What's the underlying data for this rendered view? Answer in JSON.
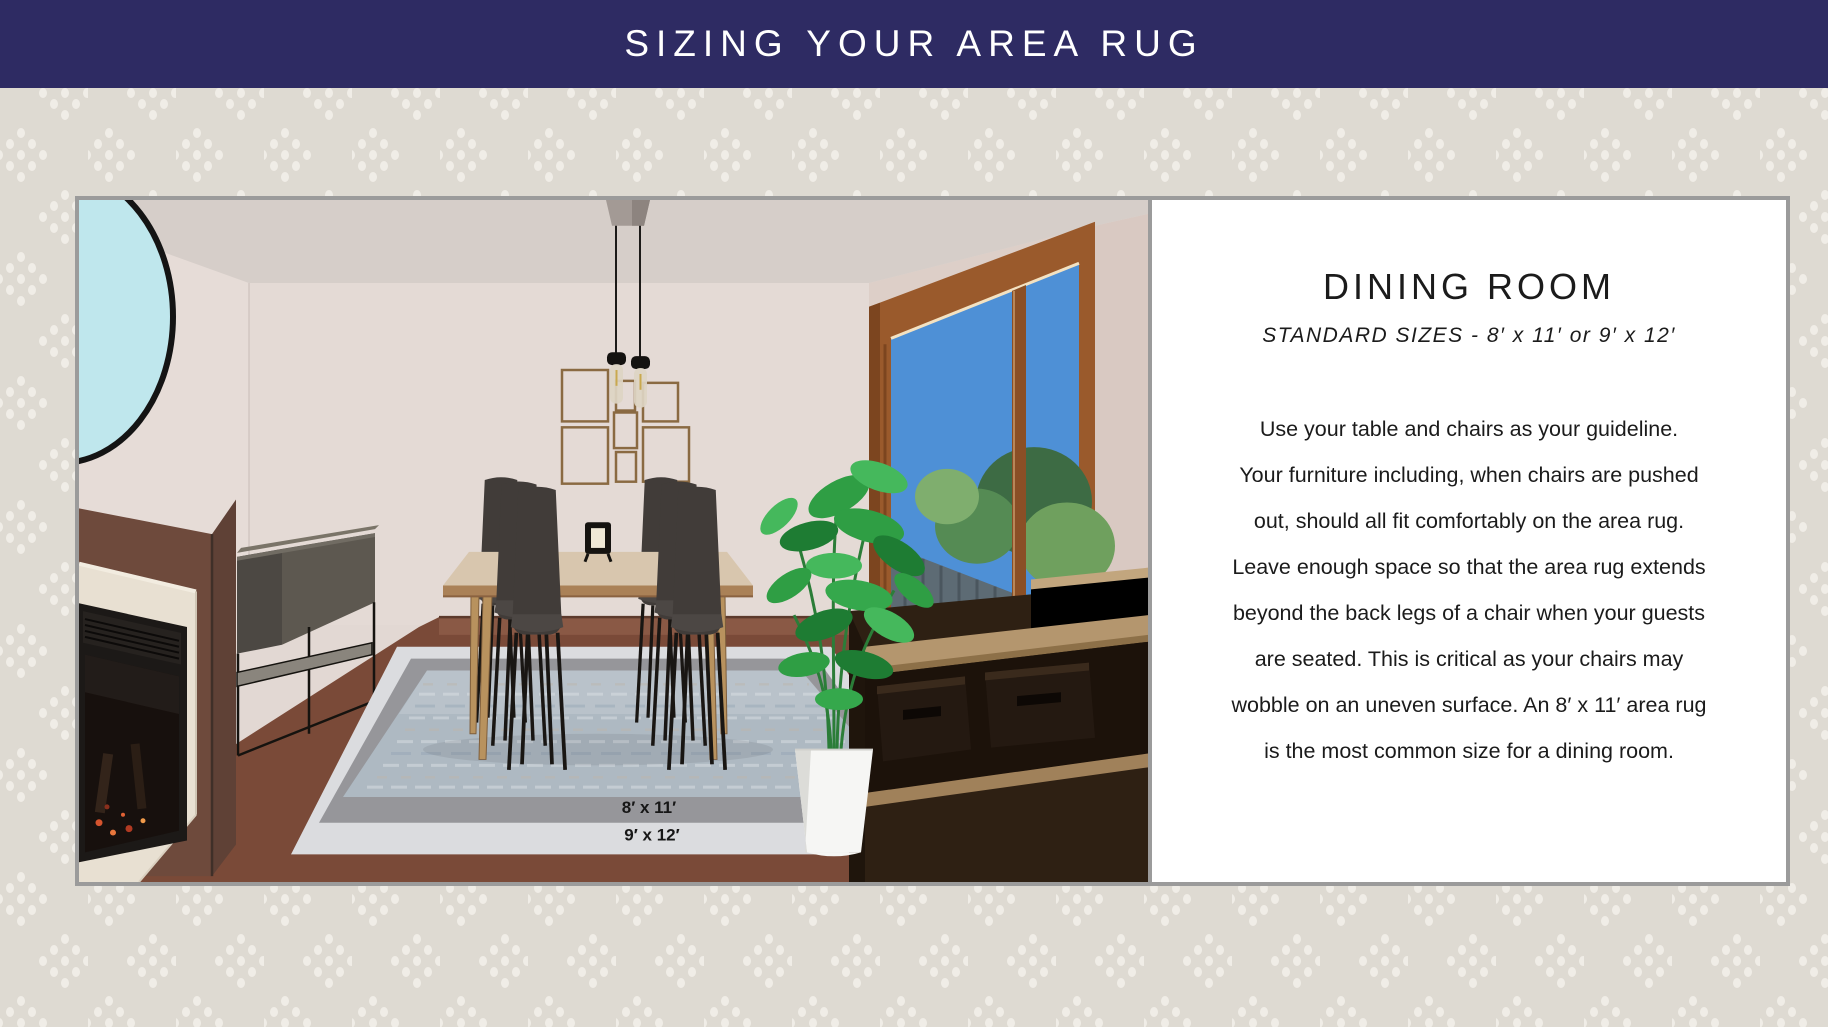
{
  "header": {
    "title": "SIZING YOUR AREA RUG",
    "bg_color": "#2e2b63",
    "text_color": "#ffffff"
  },
  "background": {
    "base_color": "#dedad2",
    "dot_color": "#f4f1eb"
  },
  "panel_border_color": "#9b9b9b",
  "illustration": {
    "rug_label_top": "8′ x 11′",
    "rug_label_bottom": "9′ x 12′"
  },
  "panel": {
    "title": "DINING ROOM",
    "subtitle": "STANDARD SIZES - 8′ x 11′ or 9′ x 12′",
    "body_lines": [
      "Use your table and chairs as your guideline.",
      "Your furniture including, when chairs are pushed",
      "out, should all fit comfortably on the area rug.",
      "Leave enough space so that the area rug extends",
      "beyond the back legs of a chair when your guests",
      "are seated. This is critical as your chairs may",
      "wobble on an uneven surface. An 8′ x 11′ area rug",
      "is the most common size for a dining room."
    ]
  }
}
